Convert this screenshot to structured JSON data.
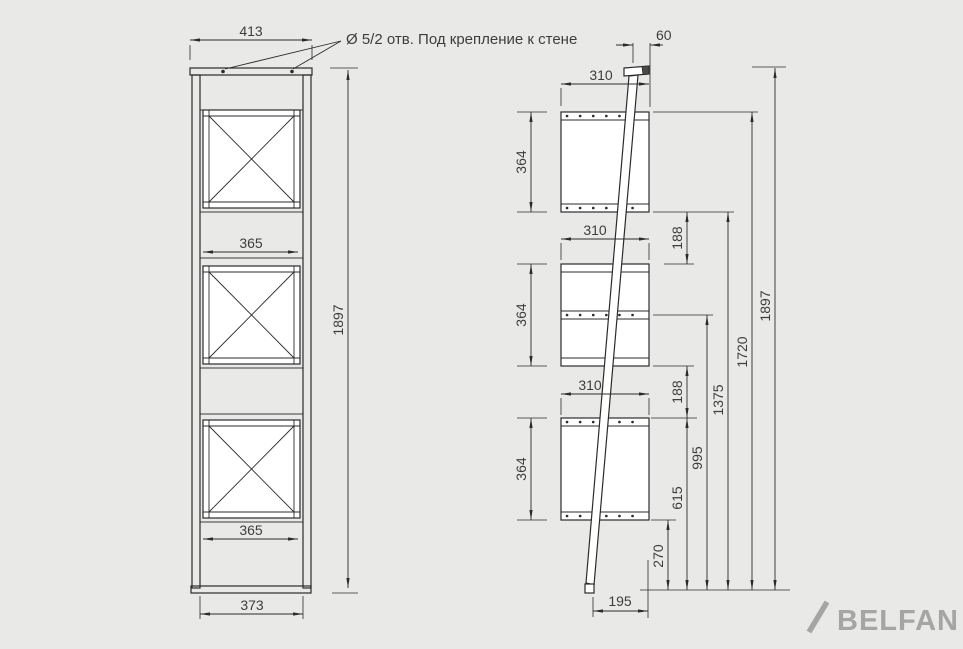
{
  "drawing": {
    "note_hole": "Ø 5/2 отв. Под крепление к стене",
    "front_view": {
      "dim_top_width": "413",
      "dim_crate_width_upper": "365",
      "dim_crate_width_lower": "365",
      "dim_base_width": "373",
      "dim_total_height": "1897"
    },
    "side_view": {
      "dim_top_offset": "60",
      "dim_shelf_depth_top": "310",
      "dim_shelf_depth_middle": "310",
      "dim_shelf_depth_bottom": "310",
      "dim_shelf_height_top": "364",
      "dim_shelf_height_middle": "364",
      "dim_shelf_height_bottom": "364",
      "dim_gap_upper": "188",
      "dim_gap_lower": "188",
      "dim_level_270": "270",
      "dim_level_615": "615",
      "dim_level_995": "995",
      "dim_level_1375": "1375",
      "dim_level_1720": "1720",
      "dim_total_height": "1897",
      "dim_foot_offset": "195"
    },
    "logo": {
      "brand": "BELFAN"
    },
    "colors": {
      "background": "#e9eae8",
      "line": "#2b2b2b",
      "text": "#3d3d3d",
      "panel_fill": "#ffffff",
      "logo": "#a5a5a5"
    }
  }
}
